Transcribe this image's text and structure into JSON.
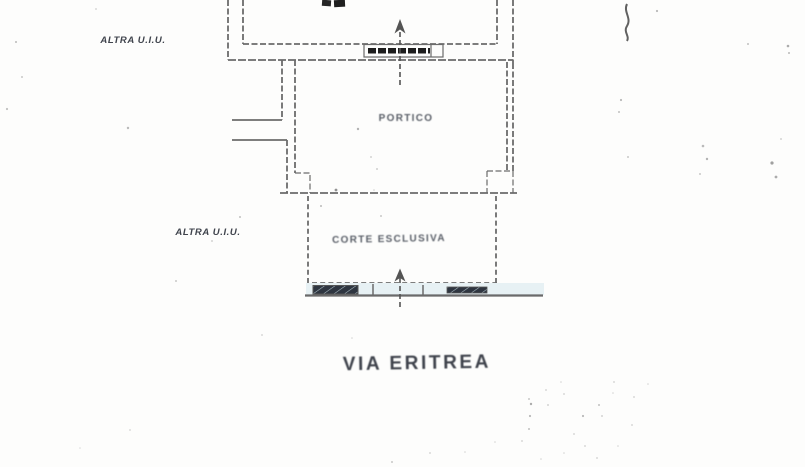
{
  "labels": {
    "adjacent_unit_top": "ALTRA U.I.U.",
    "adjacent_unit_side": "ALTRA U.I.U.",
    "portico": "PORTICO",
    "exclusive_court": "CORTE ESCLUSIVA",
    "street_name": "VIA ERITREA"
  },
  "colors": {
    "paper": "#fdfdfc",
    "wall": "#6b6b6b",
    "wall-dark": "#545454",
    "text-dark": "#3f434c",
    "text-soft": "#5a5f68",
    "ink": "#1e1e1e",
    "fence": "#2e3540",
    "fence-slit": "#aebfc6",
    "band": "#e7f1f4",
    "street": "#6a6a6a",
    "noise": "#777777"
  }
}
